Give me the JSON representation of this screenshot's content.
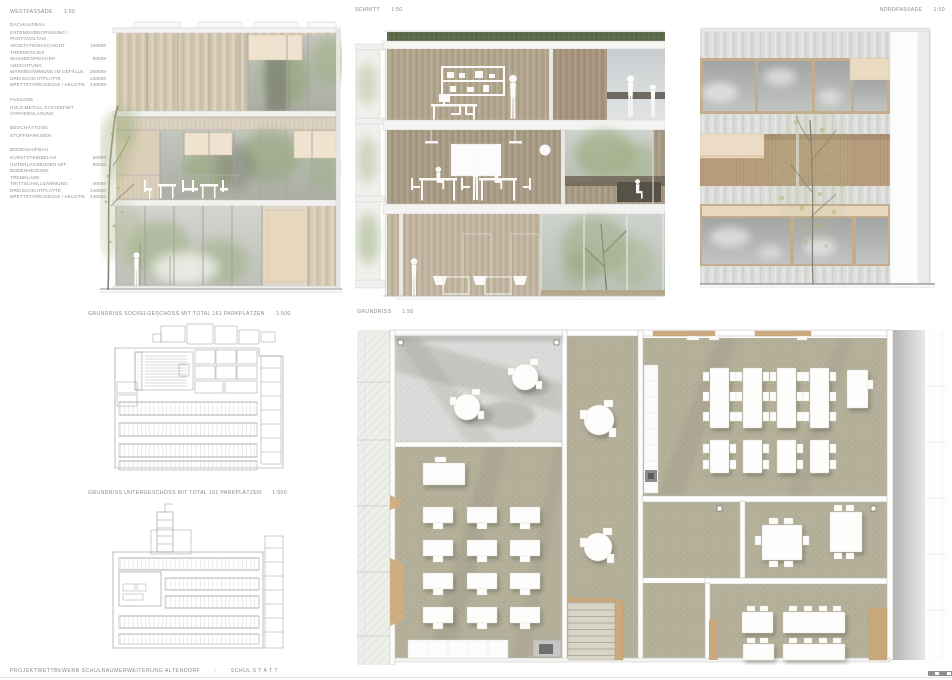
{
  "panels": {
    "west": {
      "label": "WESTFASSADE",
      "scale": "1:50"
    },
    "schnitt": {
      "label": "SCHNITT",
      "scale": "1:50"
    },
    "nord": {
      "label": "NORDFASSADE",
      "scale": "1:50"
    },
    "sockel": {
      "label": "GRUNDRISS SOCKELGESCHOSS MIT TOTAL 161 PARKPLÄTZEN",
      "scale": "1:500"
    },
    "unter": {
      "label": "GRUNDRISS UNTERGESCHOSS MIT TOTAL 161 PARKPLÄTZEN",
      "scale": "1:500"
    },
    "grundriss": {
      "label": "GRUNDRISS",
      "scale": "1:50"
    }
  },
  "legend": {
    "sections": [
      {
        "heading": "DACHAUFBAU",
        "rows": [
          {
            "label": "EXTENSIVBEGRÜNUNG / PHOTOVOLTAIK",
            "value": ""
          },
          {
            "label": "VEGETATIONSSCHICHT",
            "value": "100MM"
          },
          {
            "label": "THERMOVLIES",
            "value": ""
          },
          {
            "label": "WASSERSPEICHER",
            "value": "50MM"
          },
          {
            "label": "ABDICHTUNG",
            "value": ""
          },
          {
            "label": "WÄRMEDÄMMUNG IM GEFÄLLE",
            "value": "200MM"
          },
          {
            "label": "DREISCHICHTPLATTE",
            "value": "140MM"
          },
          {
            "label": "BRETTSTAPELDECKE / AKUSTIK",
            "value": "140MM"
          }
        ]
      },
      {
        "heading": "FASSADE",
        "rows": [
          {
            "label": "HOLZ-METALL SYSTEM MIT VORVERGLASUNG",
            "value": ""
          }
        ]
      },
      {
        "heading": "BESCHATTUNG",
        "rows": [
          {
            "label": "STOFFMARKISEN",
            "value": ""
          }
        ]
      },
      {
        "heading": "BODENAUFBAU",
        "rows": [
          {
            "label": "KUNSTSTEINBELAG",
            "value": "20MM"
          },
          {
            "label": "UNTERLAGSBODEN MIT BODENHEIZUNG",
            "value": "80MM"
          },
          {
            "label": "TRENNLAGE",
            "value": ""
          },
          {
            "label": "TRITTSCHALLDÄMMUNG",
            "value": "40MM"
          },
          {
            "label": "DREISCHICHTPLATTE",
            "value": "140MM"
          },
          {
            "label": "BRETTSTAPELDECKE / AKUSTIK",
            "value": "140MM"
          }
        ]
      }
    ]
  },
  "footer": {
    "project": "PROJEKTWETTBEWERB SCHULRAUMERWEITERUNG ALTENDORF",
    "separator": "-",
    "motto": "SCHUL S T A T T"
  },
  "colors": {
    "facade_beige": "#d6c9b3",
    "wood_accent": "#c9a87c",
    "floor_khaki": "#b5b09a",
    "terrace_gray": "#dbdbd9",
    "roof_green": "#5e6b4a",
    "plan_line_gray": "#8f8f8f",
    "text_gray": "#8a8a8a"
  }
}
